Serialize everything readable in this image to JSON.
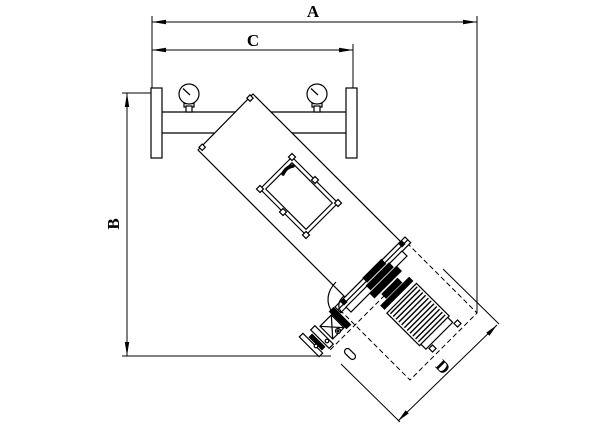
{
  "drawing": {
    "title_hidden": "",
    "dimensions": {
      "a": "A",
      "b": "B",
      "c": "C",
      "d": "D"
    }
  }
}
